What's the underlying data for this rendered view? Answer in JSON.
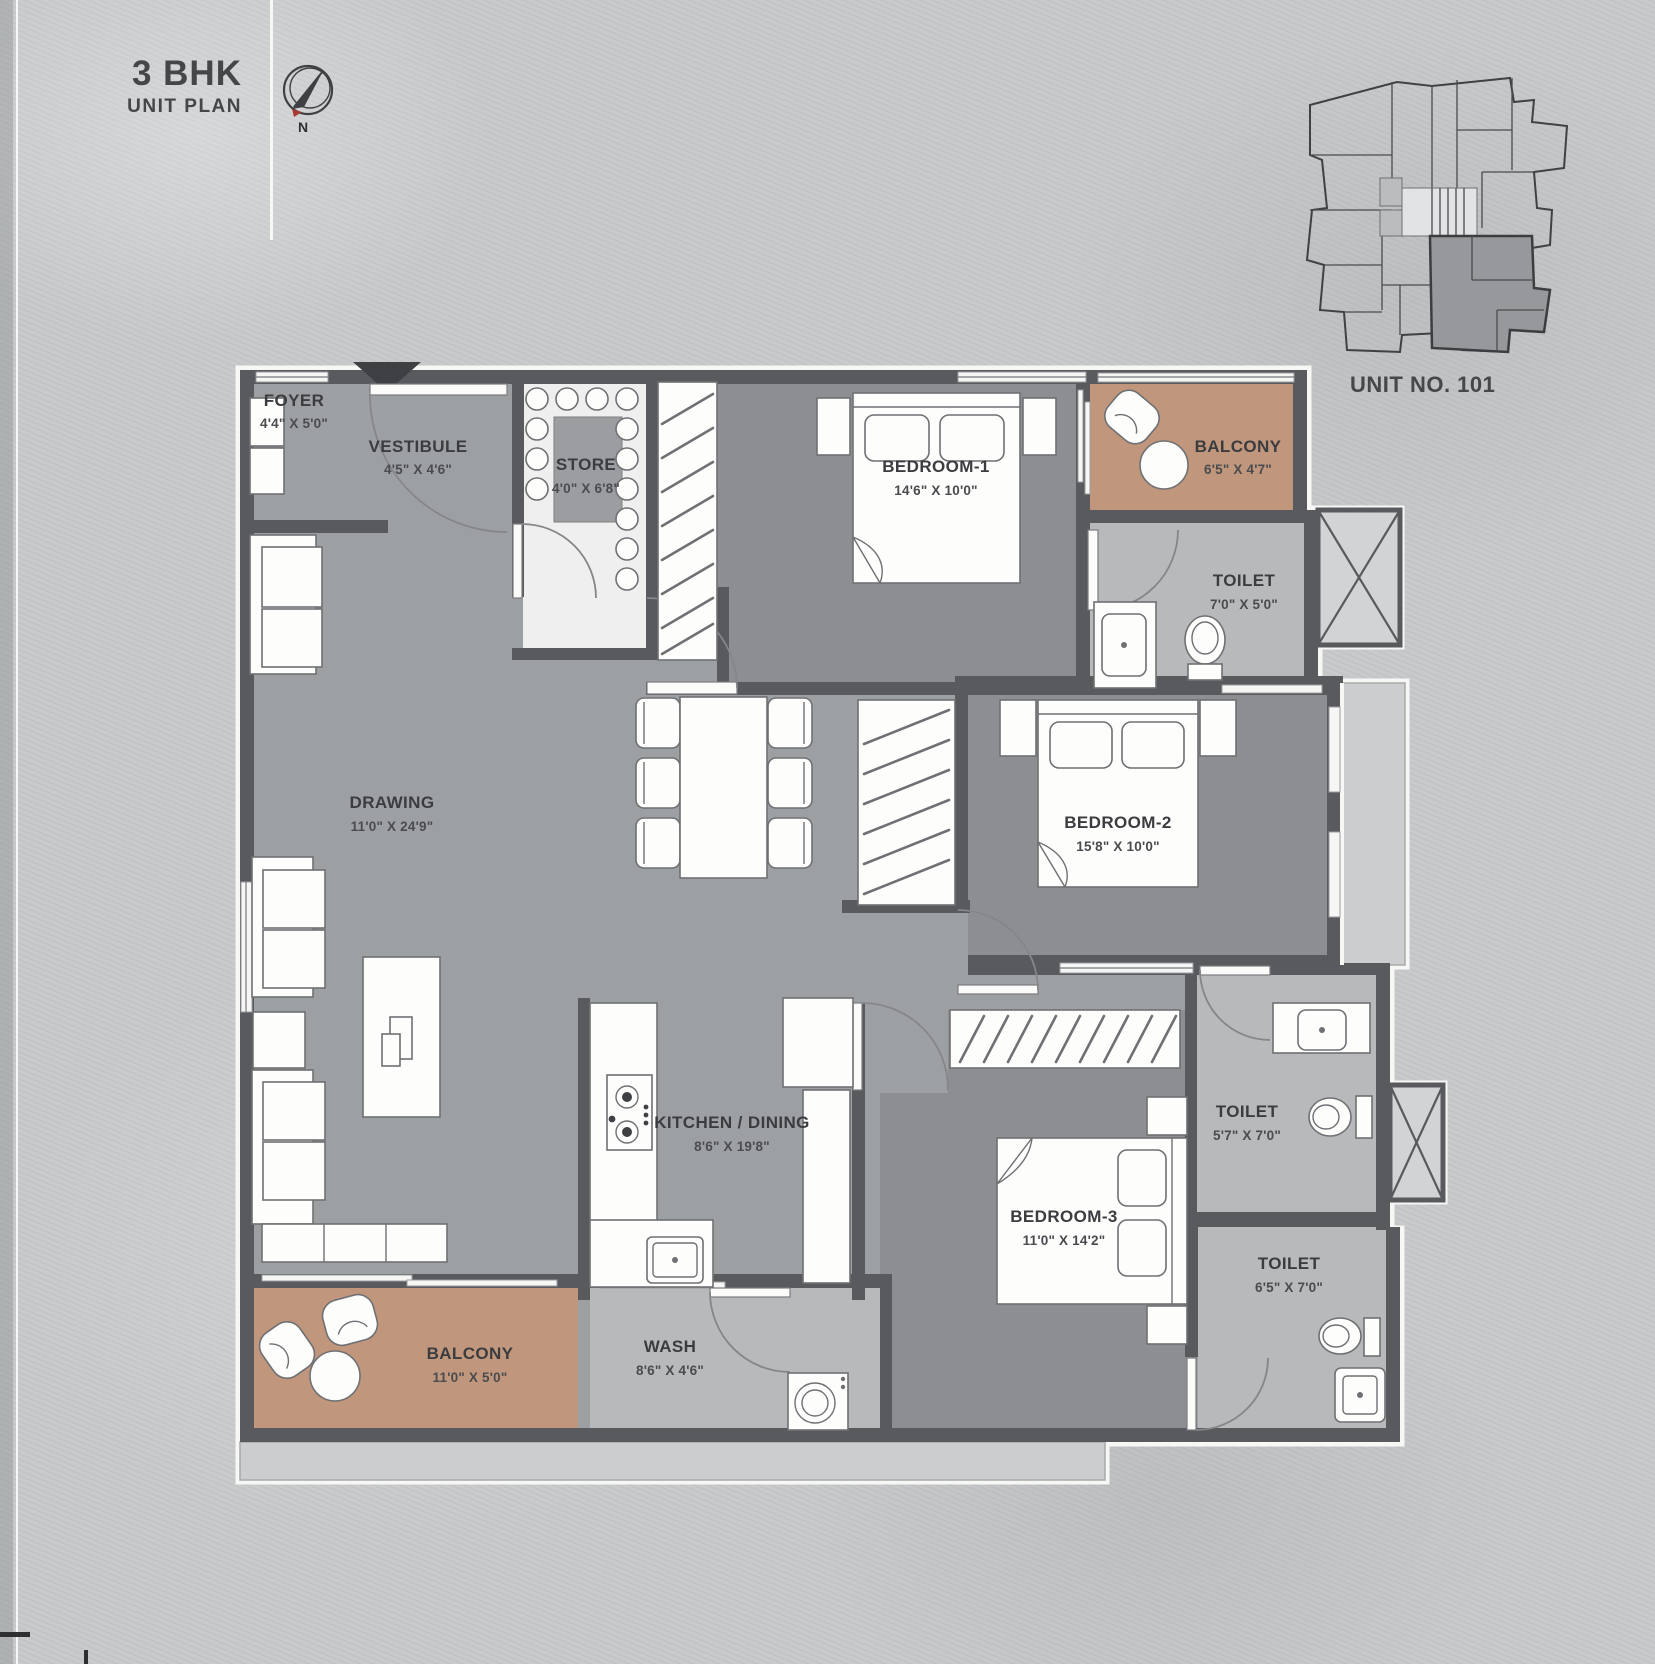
{
  "header": {
    "title": "3 BHK",
    "subtitle": "UNIT PLAN",
    "compass_n": "N"
  },
  "key_plan": {
    "caption": "UNIT NO. 101"
  },
  "rooms": {
    "foyer": {
      "name": "FOYER",
      "dims": "4'4\" X 5'0\""
    },
    "vestibule": {
      "name": "VESTIBULE",
      "dims": "4'5\" X 4'6\""
    },
    "store": {
      "name": "STORE",
      "dims": "4'0\" X 6'8\""
    },
    "bedroom1": {
      "name": "BEDROOM-1",
      "dims": "14'6\" X 10'0\""
    },
    "balcony1": {
      "name": "BALCONY",
      "dims": "6'5\" X 4'7\""
    },
    "toilet1": {
      "name": "TOILET",
      "dims": "7'0\" X 5'0\""
    },
    "drawing": {
      "name": "DRAWING",
      "dims": "11'0\" X 24'9\""
    },
    "bedroom2": {
      "name": "BEDROOM-2",
      "dims": "15'8\" X 10'0\""
    },
    "kitchen": {
      "name": "KITCHEN / DINING",
      "dims": "8'6\" X 19'8\""
    },
    "bedroom3": {
      "name": "BEDROOM-3",
      "dims": "11'0\" X 14'2\""
    },
    "toilet2": {
      "name": "TOILET",
      "dims": "5'7\" X 7'0\""
    },
    "toilet3": {
      "name": "TOILET",
      "dims": "6'5\" X 7'0\""
    },
    "wash": {
      "name": "WASH",
      "dims": "8'6\" X 4'6\""
    },
    "balcony2": {
      "name": "BALCONY",
      "dims": "11'0\" X 5'0\""
    }
  },
  "colors": {
    "wall": "#595a5d",
    "base_floor": "#9da0a3",
    "bedroom_floor": "#8c8e91",
    "wet_floor": "#b7b9bb",
    "balcony_floor": "#c0977c",
    "compass_red": "#a93a31",
    "text": "#3b3c3f"
  }
}
